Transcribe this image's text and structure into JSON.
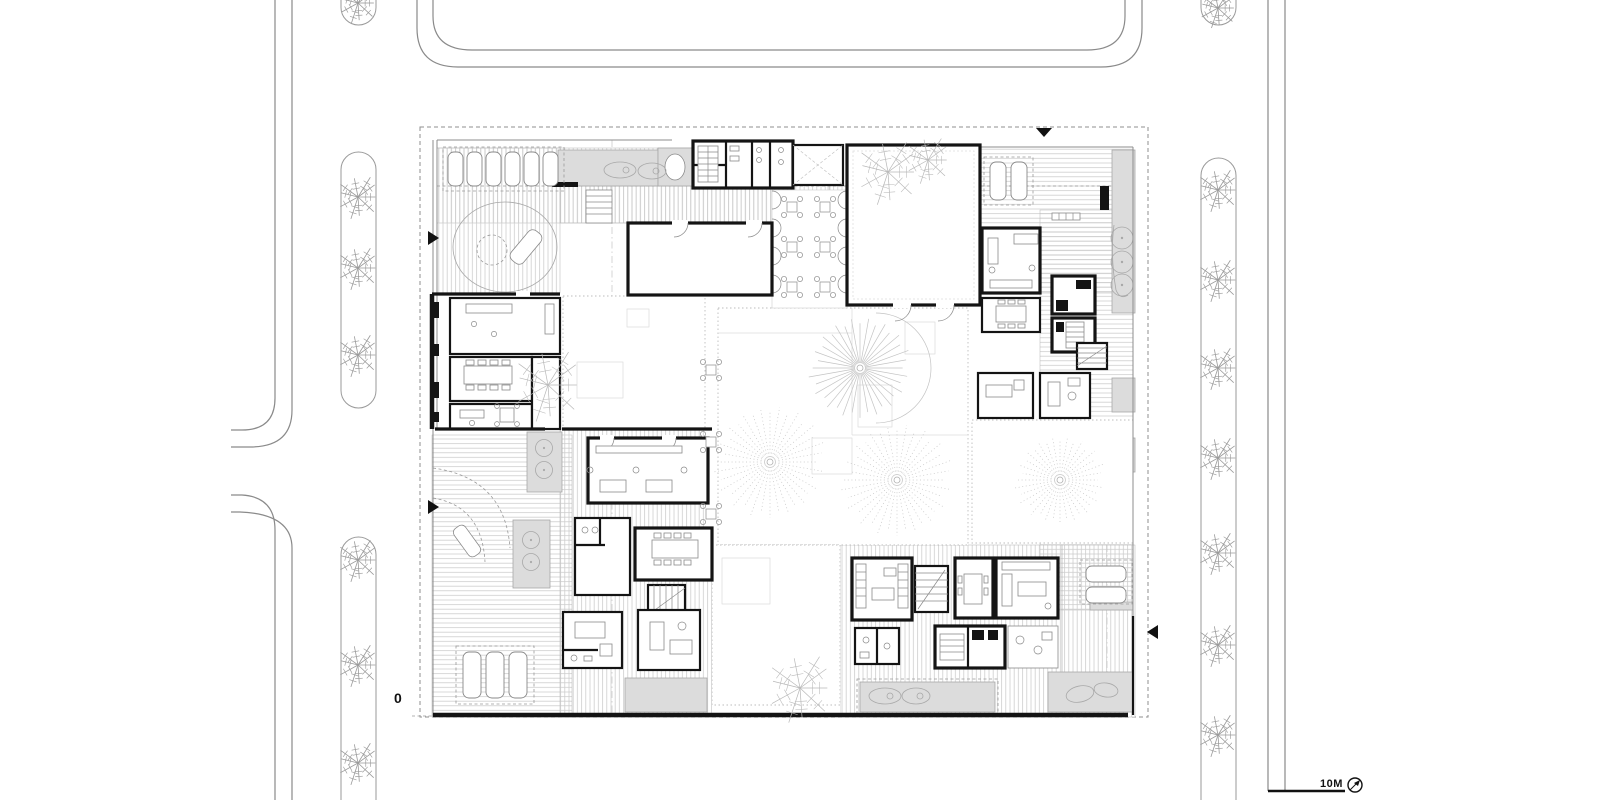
{
  "labels": {
    "origin": "0",
    "scale": "10M"
  },
  "colors": {
    "wall": "#141414",
    "road_line": "#8a8a8a",
    "hatch": "#cdcdcd",
    "terrace_gray": "#dcdcdc",
    "tree": "#9a9a9a",
    "court_tree": "#c4c4c4"
  },
  "scale_bar": {
    "label": "10M",
    "x1": 1268,
    "x2": 1345,
    "y": 791
  },
  "north_indicator": {
    "x": 1355,
    "y": 785,
    "r": 7
  },
  "origin_marker": {
    "label": "0",
    "leader": [
      412,
      716,
      433,
      716
    ]
  },
  "entry_markers": [
    {
      "name": "north-entry",
      "x": 1044,
      "y": 128,
      "dir": "down"
    },
    {
      "name": "west-entry-upper",
      "x": 428,
      "y": 238,
      "dir": "right"
    },
    {
      "name": "west-entry-lower",
      "x": 428,
      "y": 507,
      "dir": "right"
    },
    {
      "name": "east-entry",
      "x": 1158,
      "y": 632,
      "dir": "left"
    }
  ],
  "site_palms": [
    {
      "x": 358,
      "y": 3,
      "r": 22
    },
    {
      "x": 358,
      "y": 197,
      "r": 24
    },
    {
      "x": 358,
      "y": 268,
      "r": 24
    },
    {
      "x": 358,
      "y": 355,
      "r": 24
    },
    {
      "x": 358,
      "y": 560,
      "r": 24
    },
    {
      "x": 358,
      "y": 665,
      "r": 24
    },
    {
      "x": 358,
      "y": 763,
      "r": 24
    },
    {
      "x": 1218,
      "y": 8,
      "r": 22
    },
    {
      "x": 1218,
      "y": 190,
      "r": 24
    },
    {
      "x": 1218,
      "y": 280,
      "r": 24
    },
    {
      "x": 1218,
      "y": 368,
      "r": 24
    },
    {
      "x": 1218,
      "y": 458,
      "r": 24
    },
    {
      "x": 1218,
      "y": 553,
      "r": 24
    },
    {
      "x": 1218,
      "y": 645,
      "r": 24
    },
    {
      "x": 1218,
      "y": 735,
      "r": 24
    }
  ],
  "court_palms": [
    {
      "x": 548,
      "y": 385,
      "r": 40
    },
    {
      "x": 800,
      "y": 688,
      "r": 38
    },
    {
      "x": 888,
      "y": 172,
      "r": 36
    },
    {
      "x": 928,
      "y": 160,
      "r": 26
    }
  ],
  "starburst_trees": [
    {
      "x": 860,
      "y": 368,
      "r": 52,
      "style": "solid"
    },
    {
      "x": 770,
      "y": 462,
      "r": 58,
      "style": "dotted"
    },
    {
      "x": 897,
      "y": 480,
      "r": 58,
      "style": "dotted"
    },
    {
      "x": 1060,
      "y": 480,
      "r": 46,
      "style": "dotted"
    }
  ],
  "parking_groups": [
    {
      "x0": 448,
      "y0": 152,
      "n": 6,
      "w": 15,
      "h": 34,
      "dx": 19,
      "dy": 0,
      "box": [
        443,
        147,
        121,
        44
      ]
    },
    {
      "x0": 990,
      "y0": 162,
      "n": 2,
      "w": 16,
      "h": 38,
      "dx": 21,
      "dy": 0,
      "box": [
        984,
        157,
        49,
        48
      ]
    },
    {
      "x0": 463,
      "y0": 652,
      "n": 3,
      "w": 18,
      "h": 46,
      "dx": 23,
      "dy": 0,
      "box": [
        456,
        646,
        78,
        58
      ]
    },
    {
      "x0": 1086,
      "y0": 566,
      "n": 2,
      "w": 40,
      "h": 16,
      "dx": 0,
      "dy": 21,
      "box": [
        1080,
        560,
        52,
        44
      ]
    }
  ],
  "court_tables": [
    {
      "x": 792,
      "y": 207
    },
    {
      "x": 825,
      "y": 207
    },
    {
      "x": 792,
      "y": 247
    },
    {
      "x": 825,
      "y": 247
    },
    {
      "x": 792,
      "y": 287
    },
    {
      "x": 825,
      "y": 287
    },
    {
      "x": 711,
      "y": 370
    },
    {
      "x": 711,
      "y": 442
    },
    {
      "x": 711,
      "y": 514
    }
  ]
}
